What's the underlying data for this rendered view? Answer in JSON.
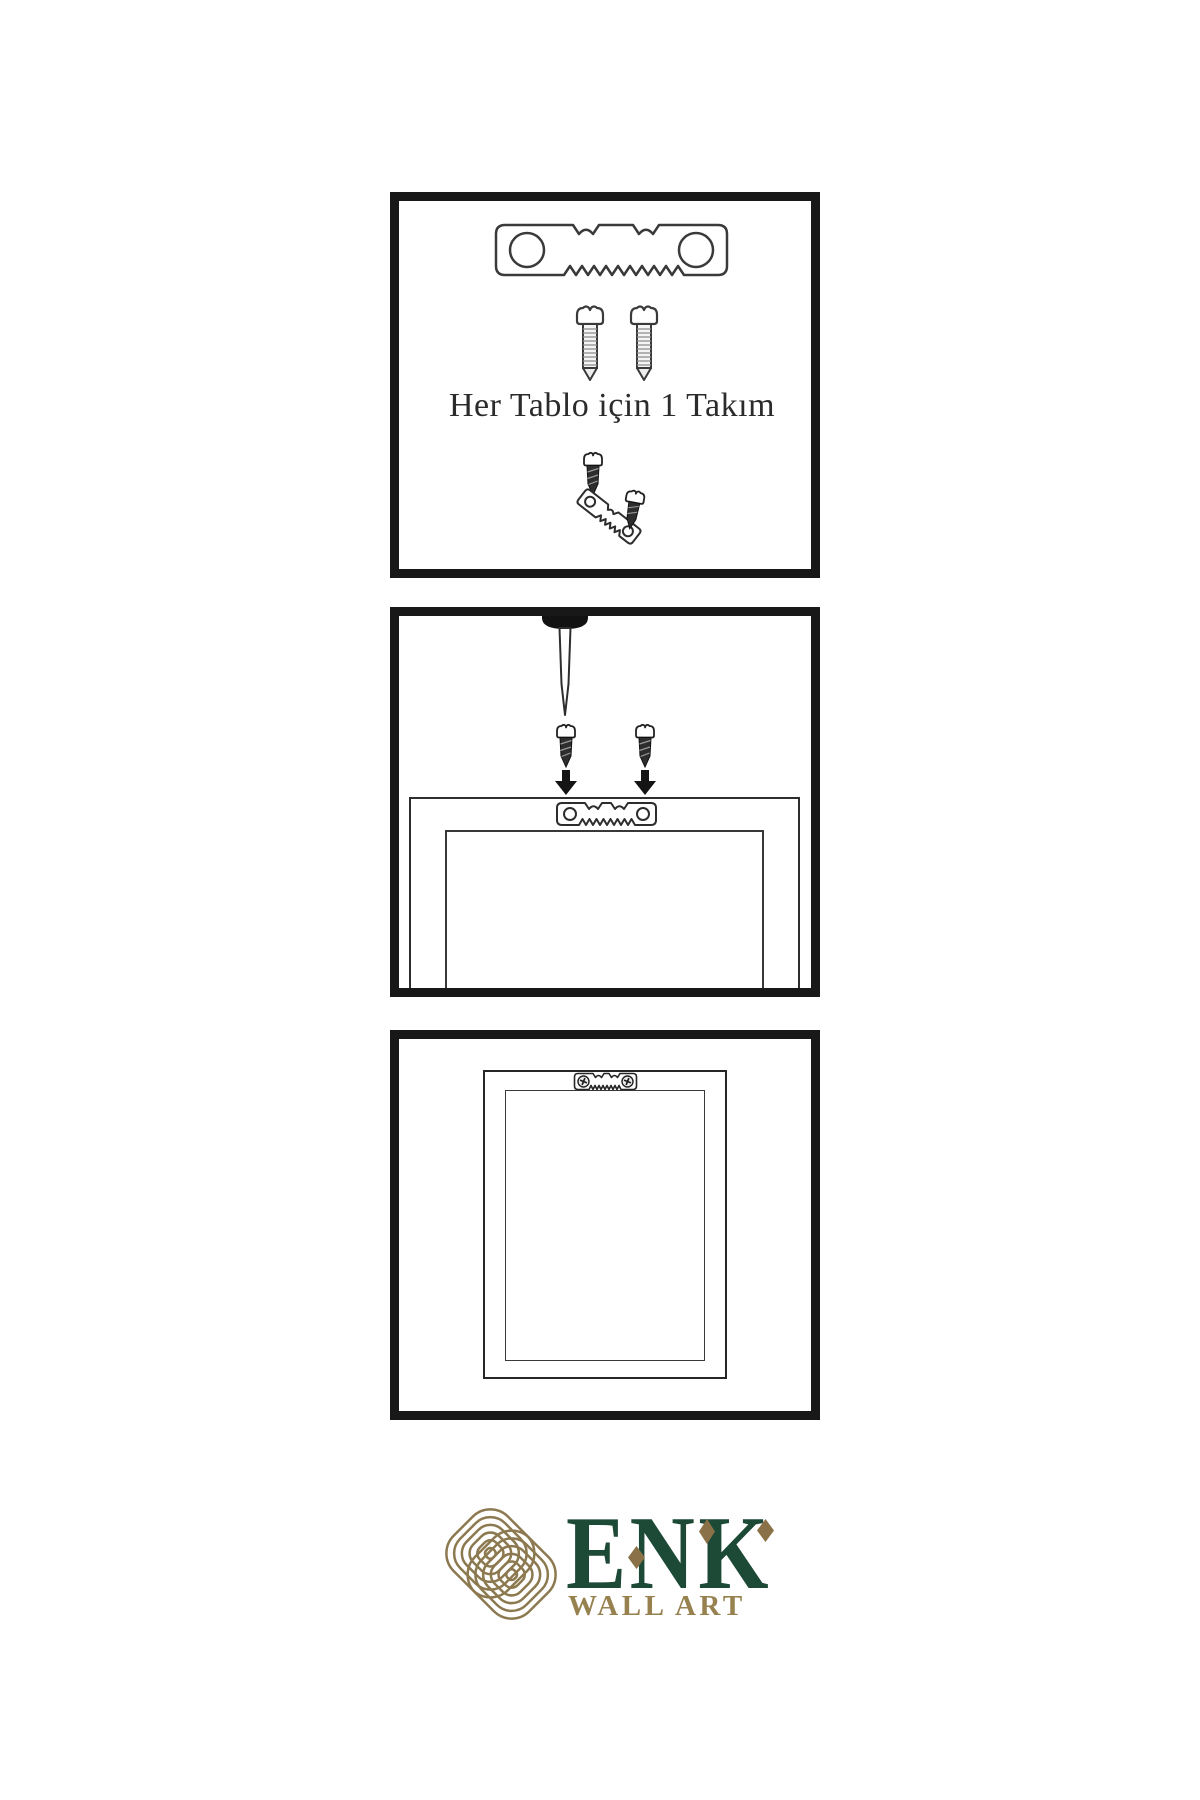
{
  "panels": [
    {
      "id": "hardware-kit",
      "caption": "Her Tablo için 1 Takım",
      "contents": [
        "sawtooth-hanger",
        "screw",
        "screw",
        "screw-dark",
        "sawtooth-hanger-tilted",
        "screw-dark-tilted"
      ]
    },
    {
      "id": "install-step",
      "contents": [
        "wall-nail",
        "screw-dark",
        "screw-dark",
        "arrow-down",
        "arrow-down",
        "frame-back-with-hanger"
      ]
    },
    {
      "id": "hung-frame",
      "contents": [
        "frame-back",
        "sawtooth-hanger-with-screws"
      ]
    }
  ],
  "brand": {
    "name": "ENK",
    "subtitle": "WALL ART",
    "name_color": "#1d4937",
    "subtitle_color": "#96814f",
    "knot_color": "#8c7950",
    "diamond_color": "#8a7147"
  },
  "colors": {
    "page_background": "#ffffff",
    "panel_border": "#181818",
    "line_art": "#333333",
    "dark_hardware": "#2d2d2d"
  }
}
